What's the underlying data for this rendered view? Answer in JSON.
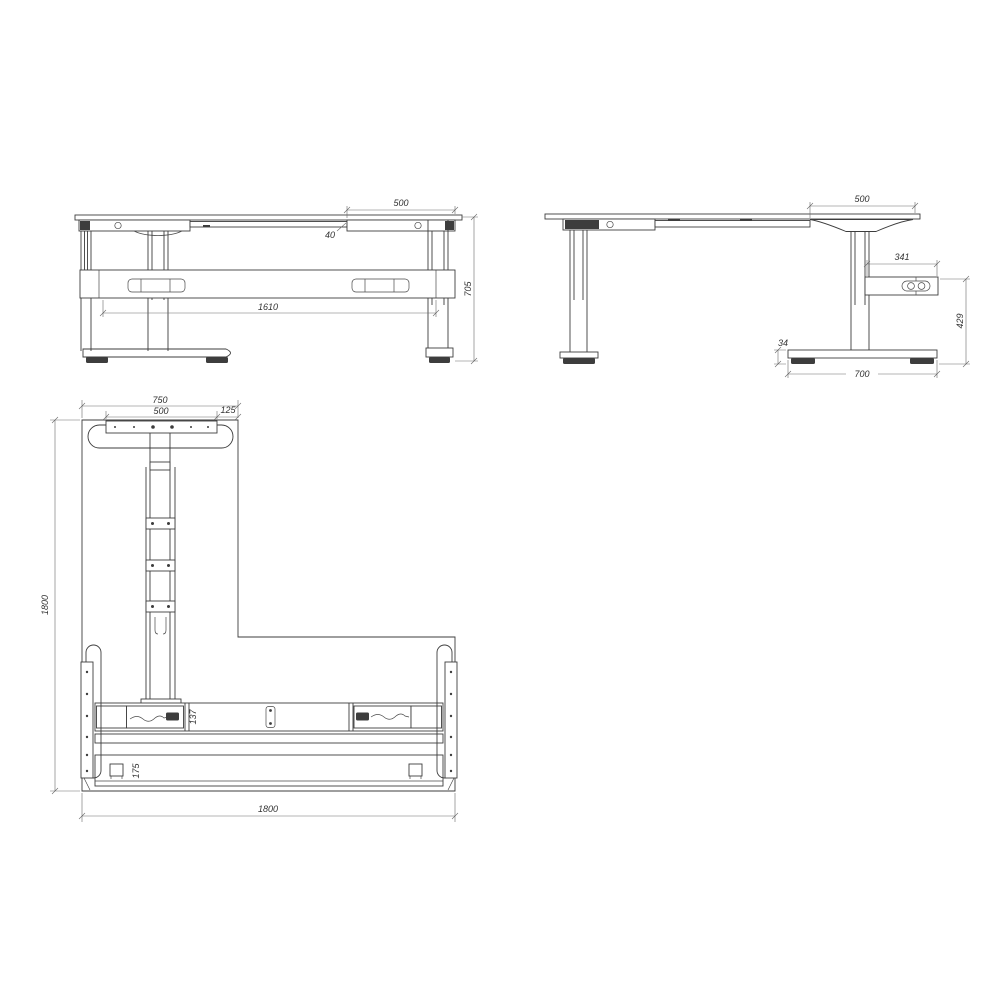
{
  "title": "L-shaped height adjustable desk frame - dimensioned technical drawing",
  "front": {
    "overhang": "500",
    "top_offset": "40",
    "leg_span": "1610",
    "height": "705"
  },
  "side": {
    "overhang": "500",
    "control_box_width": "341",
    "box_to_floor": "429",
    "foot_height": "34",
    "foot_length": "700"
  },
  "plan": {
    "top_width": "750",
    "bracket_width": "500",
    "edge_gap": "125",
    "depth": "1800",
    "width": "1800",
    "beam_width": "137",
    "panel_width": "175"
  }
}
